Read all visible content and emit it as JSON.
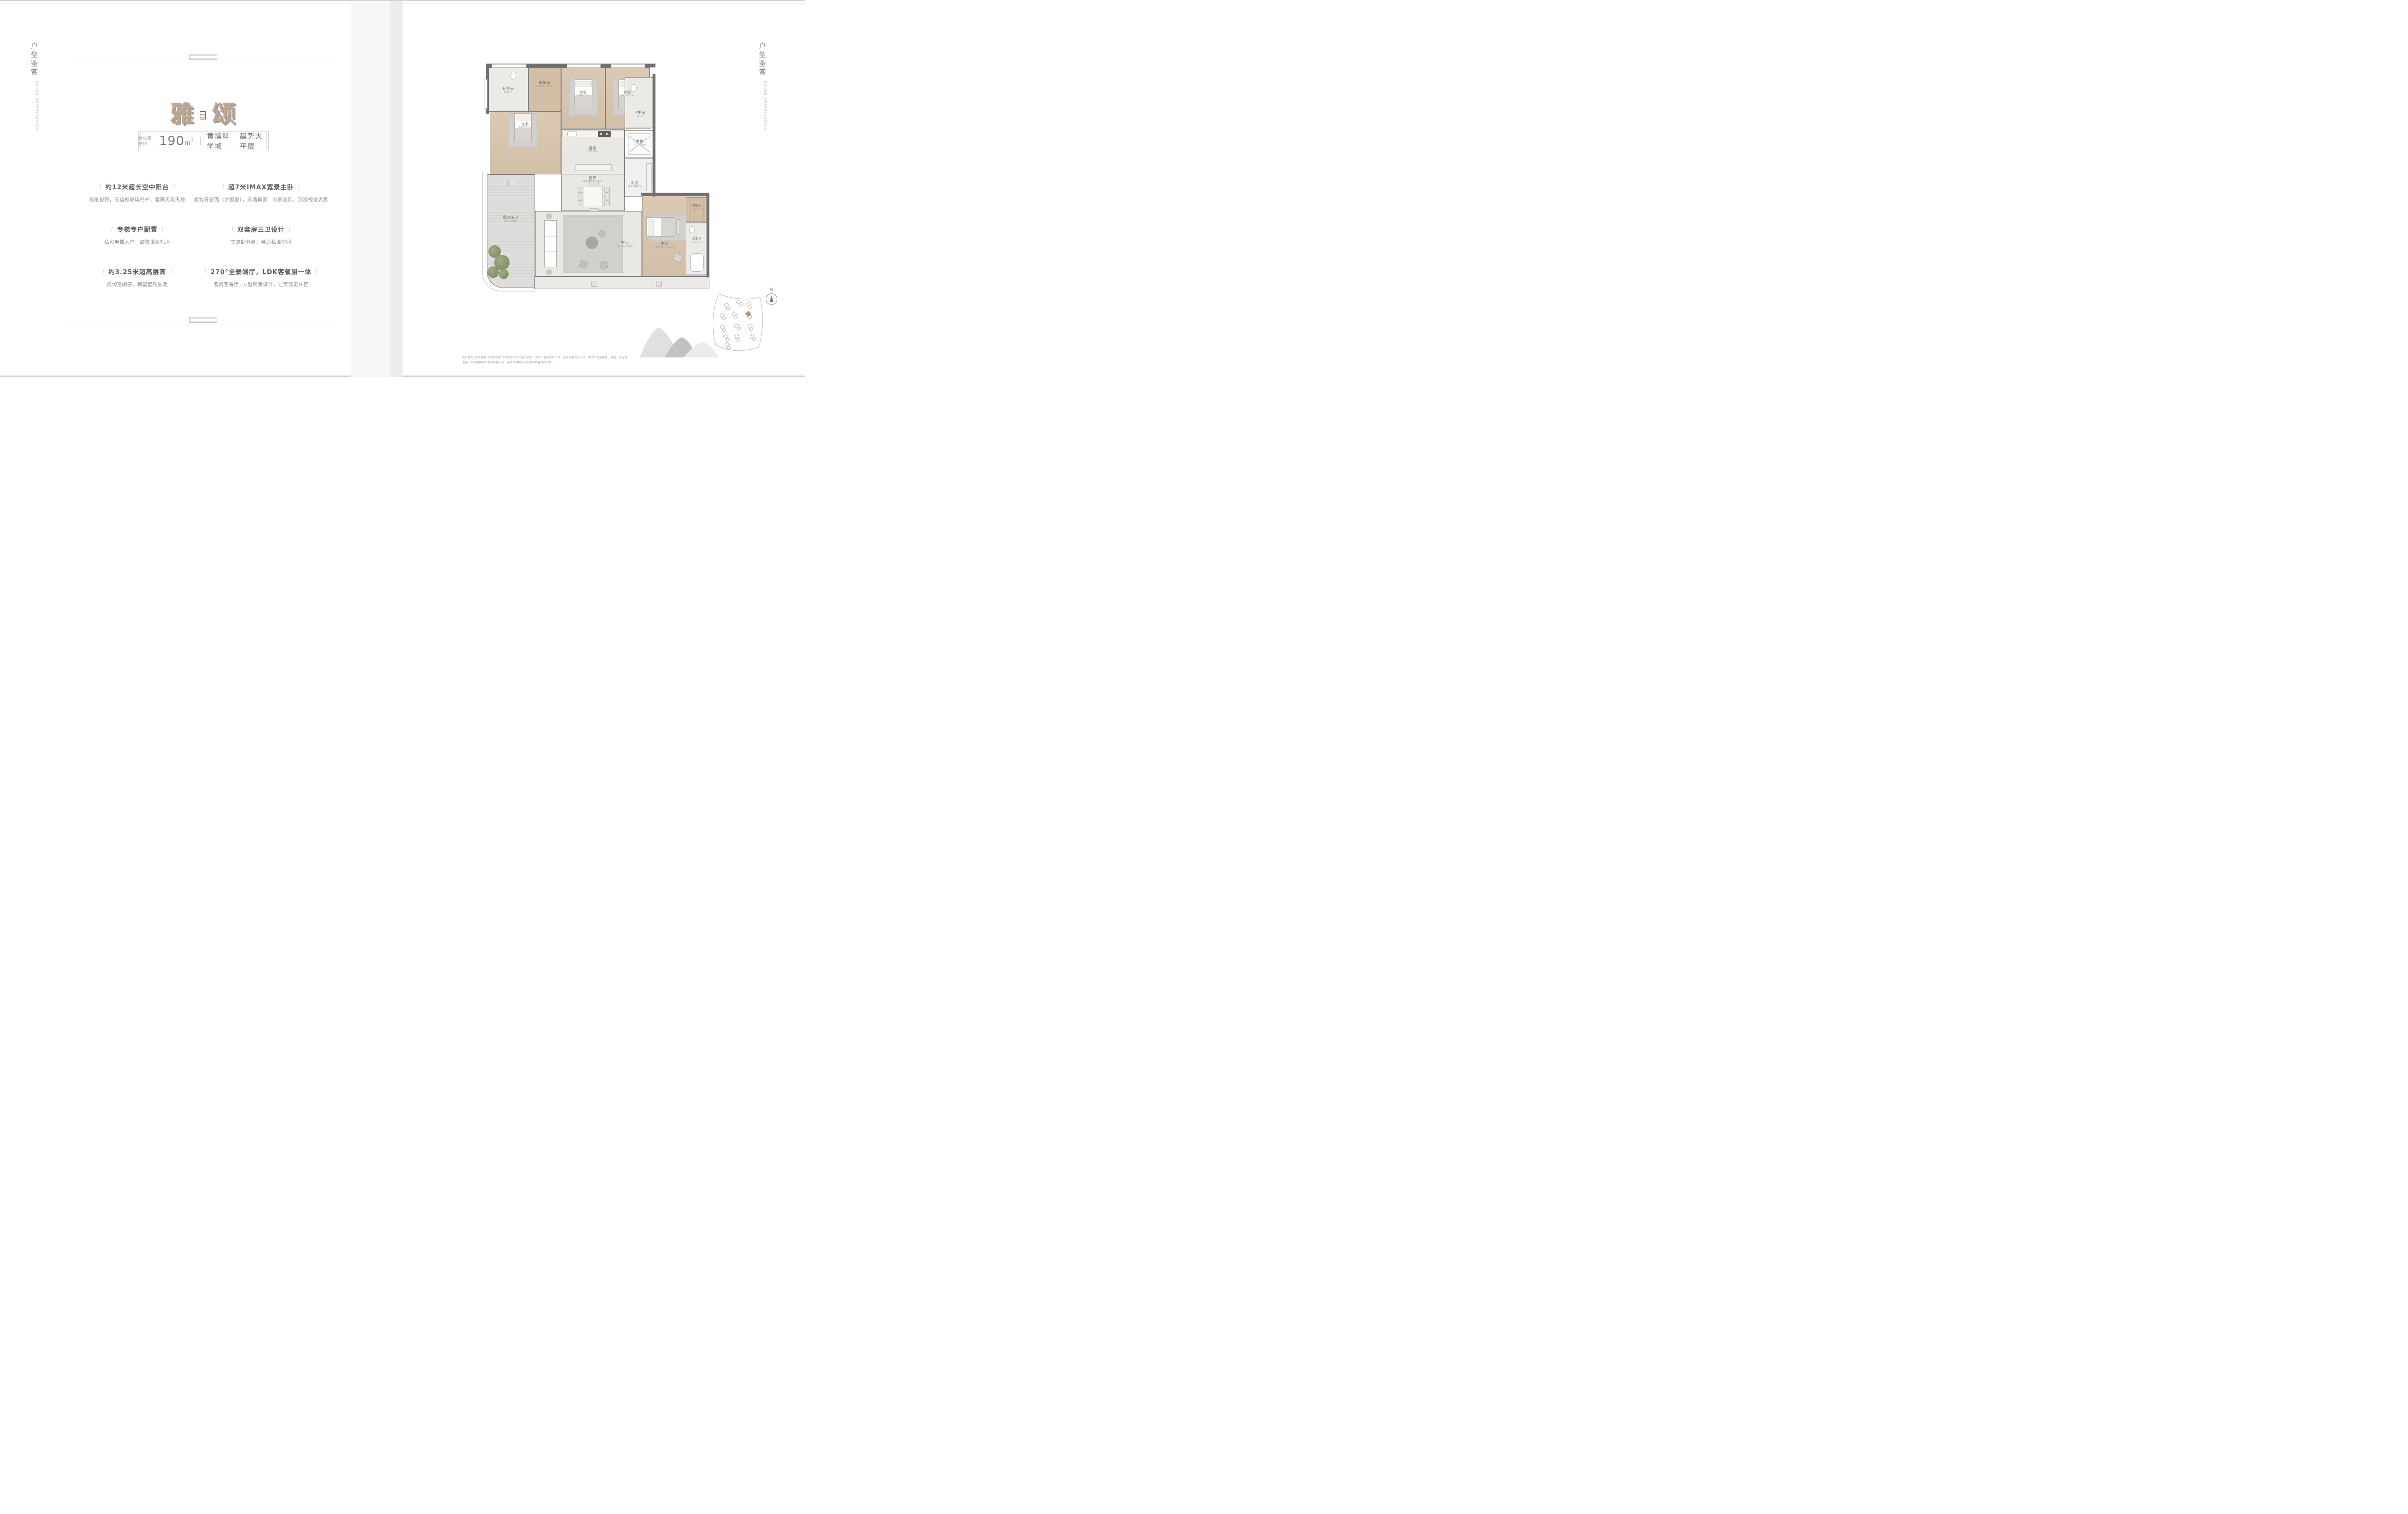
{
  "sidebar": {
    "cn": "户型鉴赏",
    "en": "HOUSE APPRECIATION"
  },
  "left_page": {
    "title": {
      "char1": "雅",
      "char2": "颂",
      "color": "#c2a78e",
      "shadow_color": "#9e9e9e",
      "seal_color": "#a4483c"
    },
    "badge": {
      "area_prefix": "建筑面积约",
      "area_value": "190",
      "area_unit": "m",
      "area_sup": "2",
      "location": "黄埔科学城",
      "tagline": "趋势大平层"
    },
    "features": [
      {
        "title": "约12米超长空中阳台",
        "desc": "观景视野，无边框玻璃栏杆，奢藏无垠天地"
      },
      {
        "title": "超7米IMAX宽景主卧",
        "desc": "极致开窗面（含飘窗），无墙幕窗、山景浴缸，沉浸视觉大赏"
      },
      {
        "title": "专梯专户配置",
        "desc": "私家电梯入户，致敬世家礼序"
      },
      {
        "title": "双套房三卫设计",
        "desc": "主次卧分离，奢适私谧空间"
      },
      {
        "title": "约3.25米超高层高",
        "desc": "阔绰空间感，精塑墅质生活"
      },
      {
        "title": "270°全景端厅，LDK客餐厨一体",
        "desc": "奢阔客餐厅，U型厨房设计，让烹饪更从容"
      }
    ]
  },
  "right_page": {
    "floor_plan": {
      "rooms": [
        {
          "cn": "卫生间",
          "en": "TOILET"
        },
        {
          "cn": "衣帽间",
          "en": "CLOAK ROOM"
        },
        {
          "cn": "次卧",
          "en": "BEDROOM"
        },
        {
          "cn": "次卧",
          "en": "BEDROOM"
        },
        {
          "cn": "次卧",
          "en": "BEDROOM"
        },
        {
          "cn": "卫生间",
          "en": "TOILET"
        },
        {
          "cn": "电梯",
          "en": "LIFT LOBBY"
        },
        {
          "cn": "玄关",
          "en": "VESRIBULE"
        },
        {
          "cn": "厨房",
          "en": "KITCHEN"
        },
        {
          "cn": "餐厅",
          "en": "DINNING ROOM"
        },
        {
          "cn": "景观阳台",
          "en": "BALACONY"
        },
        {
          "cn": "客厅",
          "en": "LIVING ROOM"
        },
        {
          "cn": "主卧",
          "en": "MASTER ROOM"
        },
        {
          "cn": "衣帽间",
          "en": "CLOAK ROOM"
        },
        {
          "cn": "卫生间",
          "en": "TOILET"
        }
      ]
    },
    "compass_label": "N",
    "disclaimer": "本户型为“长岭雅居”项目8号楼02号房的平面户型示意图。不同户型的面积尺寸、空间分割均有不同，相同户型因楼栋、楼层、单元等差别，局部结构面积等也可能不同，具体以最终审定图纸和销售合同为准。"
  }
}
